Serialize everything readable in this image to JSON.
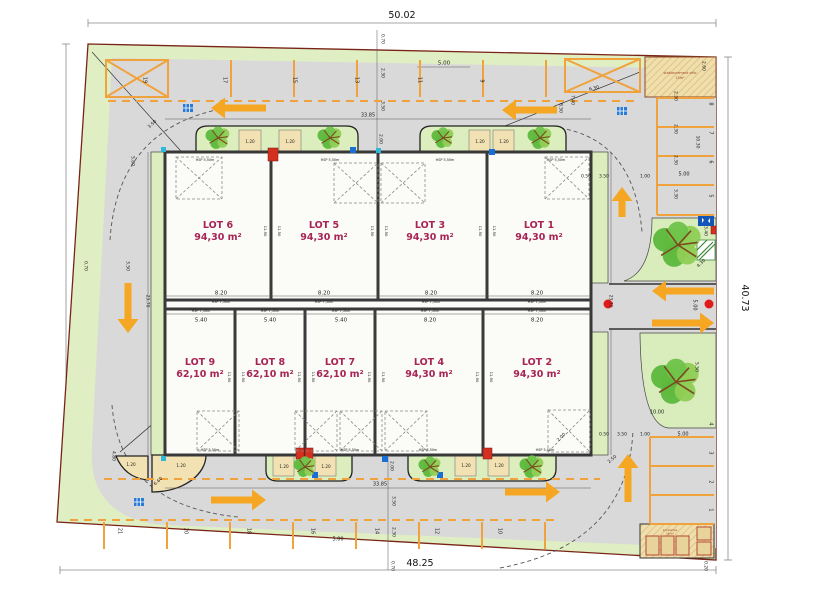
{
  "plan": {
    "outer": {
      "top": "50.02",
      "bottom": "48.25",
      "left": "40.77",
      "right": "40.73"
    },
    "colors": {
      "site_green": "#DFEFC3",
      "verge_green": "#DCEEBD",
      "asphalt": "#D9D9D9",
      "marking_orange": "#F0A23C",
      "arrow_orange": "#F5A623",
      "wall_dark": "#3A3A3A",
      "boundary_red": "#7A2417",
      "lot_label": "#A62456",
      "planter_tan": "#F2E2B3",
      "hatch_tan": "#F0DFAC",
      "red_dot": "#E01B1B",
      "utility_blue": "#1A6FD4",
      "utility_cyan": "#2FB8D8",
      "sign_blue": "#1456B8"
    },
    "lots": [
      {
        "name": "LOT 6",
        "area": "94,30 m²",
        "x": 218,
        "y": 228
      },
      {
        "name": "LOT 5",
        "area": "94,30 m²",
        "x": 324,
        "y": 228
      },
      {
        "name": "LOT 3",
        "area": "94,30 m²",
        "x": 430,
        "y": 228
      },
      {
        "name": "LOT 1",
        "area": "94,30 m²",
        "x": 539,
        "y": 228
      },
      {
        "name": "LOT 9",
        "area": "62,10 m²",
        "x": 200,
        "y": 365
      },
      {
        "name": "LOT 8",
        "area": "62,10 m²",
        "x": 270,
        "y": 365
      },
      {
        "name": "LOT 7",
        "area": "62,10 m²",
        "x": 340,
        "y": 365
      },
      {
        "name": "LOT 4",
        "area": "94,30 m²",
        "x": 429,
        "y": 365
      },
      {
        "name": "LOT 2",
        "area": "94,30 m²",
        "x": 537,
        "y": 365
      }
    ],
    "stalls": [
      {
        "n": "19",
        "x": 145,
        "y": 80
      },
      {
        "n": "17",
        "x": 225,
        "y": 80
      },
      {
        "n": "15",
        "x": 295,
        "y": 80
      },
      {
        "n": "13",
        "x": 357,
        "y": 80
      },
      {
        "n": "11",
        "x": 420,
        "y": 80
      },
      {
        "n": "9",
        "x": 482,
        "y": 81
      },
      {
        "n": "21",
        "x": 120,
        "y": 531
      },
      {
        "n": "20",
        "x": 186,
        "y": 531
      },
      {
        "n": "18",
        "x": 249,
        "y": 531
      },
      {
        "n": "16",
        "x": 313,
        "y": 531
      },
      {
        "n": "14",
        "x": 377,
        "y": 531
      },
      {
        "n": "12",
        "x": 437,
        "y": 531
      },
      {
        "n": "10",
        "x": 500,
        "y": 531
      },
      {
        "n": "8",
        "x": 711,
        "y": 104
      },
      {
        "n": "7",
        "x": 711,
        "y": 133
      },
      {
        "n": "6",
        "x": 711,
        "y": 162
      },
      {
        "n": "5",
        "x": 711,
        "y": 196
      },
      {
        "n": "4",
        "x": 711,
        "y": 424
      },
      {
        "n": "3",
        "x": 711,
        "y": 453
      },
      {
        "n": "2",
        "x": 711,
        "y": 482
      },
      {
        "n": "1",
        "x": 711,
        "y": 510
      }
    ],
    "dim_labels": [
      {
        "t": "0.70",
        "x": 383,
        "y": 39,
        "r": 90,
        "s": 4.5
      },
      {
        "t": "2.30",
        "x": 383,
        "y": 73,
        "r": 90,
        "s": 4.5
      },
      {
        "t": "3.50",
        "x": 383,
        "y": 106,
        "r": 90,
        "s": 4.5
      },
      {
        "t": "2.00",
        "x": 381,
        "y": 139,
        "r": 90,
        "s": 4.5
      },
      {
        "t": "5.00",
        "x": 444,
        "y": 63,
        "s": 5.5
      },
      {
        "t": "33.85",
        "x": 368,
        "y": 115,
        "s": 5
      },
      {
        "t": "3.50",
        "x": 152,
        "y": 124,
        "r": -42,
        "s": 4.5
      },
      {
        "t": "5.80",
        "x": 133,
        "y": 161,
        "r": 90,
        "s": 4.5
      },
      {
        "t": "8.50",
        "x": 561,
        "y": 108,
        "r": 90,
        "s": 4.5
      },
      {
        "t": "7.40",
        "x": 573,
        "y": 100,
        "r": 90,
        "s": 4.5
      },
      {
        "t": "6.30",
        "x": 594,
        "y": 88,
        "r": -14,
        "s": 4.5
      },
      {
        "t": "2.60",
        "x": 704,
        "y": 66,
        "r": 90,
        "s": 4.5
      },
      {
        "t": "10.30",
        "x": 698,
        "y": 142,
        "r": 90,
        "s": 4.5
      },
      {
        "t": "2.30",
        "x": 676,
        "y": 96,
        "r": 90,
        "s": 4.5
      },
      {
        "t": "2.30",
        "x": 676,
        "y": 129,
        "r": 90,
        "s": 4.5
      },
      {
        "t": "2.30",
        "x": 676,
        "y": 160,
        "r": 90,
        "s": 4.5
      },
      {
        "t": "3.30",
        "x": 676,
        "y": 194,
        "r": 90,
        "s": 4.5
      },
      {
        "t": "5.00",
        "x": 684,
        "y": 174,
        "s": 5
      },
      {
        "t": "0.50",
        "x": 586,
        "y": 176,
        "s": 4.5
      },
      {
        "t": "3.50",
        "x": 604,
        "y": 176,
        "s": 4.5
      },
      {
        "t": "1.00",
        "x": 645,
        "y": 176,
        "s": 4.5
      },
      {
        "t": "3.40",
        "x": 706,
        "y": 231,
        "r": 90,
        "s": 4.5
      },
      {
        "t": "4.30",
        "x": 701,
        "y": 263,
        "r": -45,
        "s": 4.5
      },
      {
        "t": "5.00",
        "x": 695,
        "y": 305,
        "r": 90,
        "s": 5
      },
      {
        "t": "23.70",
        "x": 611,
        "y": 301,
        "r": 90,
        "s": 4.5
      },
      {
        "t": "23.70",
        "x": 148,
        "y": 301,
        "r": 90,
        "s": 4.5
      },
      {
        "t": "0.70",
        "x": 86,
        "y": 266,
        "r": 90,
        "s": 4.5
      },
      {
        "t": "3.50",
        "x": 128,
        "y": 266,
        "r": 90,
        "s": 4.5
      },
      {
        "t": "5.50",
        "x": 697,
        "y": 367,
        "r": 90,
        "s": 4.5
      },
      {
        "t": "0.50",
        "x": 604,
        "y": 434,
        "s": 4.5
      },
      {
        "t": "3.50",
        "x": 622,
        "y": 434,
        "s": 4.5
      },
      {
        "t": "1.00",
        "x": 645,
        "y": 434,
        "s": 4.5
      },
      {
        "t": "5.00",
        "x": 683,
        "y": 434,
        "s": 5
      },
      {
        "t": "10.00",
        "x": 657,
        "y": 412,
        "s": 5
      },
      {
        "t": "2.50",
        "x": 612,
        "y": 459,
        "r": -40,
        "s": 4.5
      },
      {
        "t": "2.00",
        "x": 561,
        "y": 437,
        "r": -45,
        "s": 4.5
      },
      {
        "t": "4.80",
        "x": 114,
        "y": 456,
        "r": 90,
        "s": 4.5
      },
      {
        "t": "6.60",
        "x": 158,
        "y": 481,
        "r": -42,
        "s": 4.5
      },
      {
        "t": "33.85",
        "x": 380,
        "y": 484,
        "s": 5
      },
      {
        "t": "2.00",
        "x": 392,
        "y": 466,
        "r": 90,
        "s": 4.5
      },
      {
        "t": "3.50",
        "x": 394,
        "y": 501,
        "r": 90,
        "s": 4.5
      },
      {
        "t": "2.30",
        "x": 394,
        "y": 532,
        "r": 90,
        "s": 4.5
      },
      {
        "t": "0.70",
        "x": 393,
        "y": 566,
        "r": 90,
        "s": 4.5
      },
      {
        "t": "5.00",
        "x": 338,
        "y": 539,
        "s": 5
      },
      {
        "t": "0.20",
        "x": 706,
        "y": 566,
        "r": 90,
        "s": 4.5
      },
      {
        "t": "8.20",
        "x": 221,
        "y": 293,
        "s": 5.5
      },
      {
        "t": "8.20",
        "x": 324,
        "y": 293,
        "s": 5.5
      },
      {
        "t": "8.20",
        "x": 431,
        "y": 293,
        "s": 5.5
      },
      {
        "t": "8.20",
        "x": 537,
        "y": 293,
        "s": 5.5
      },
      {
        "t": "5.40",
        "x": 201,
        "y": 320,
        "s": 5.5
      },
      {
        "t": "5.40",
        "x": 270,
        "y": 320,
        "s": 5.5
      },
      {
        "t": "5.40",
        "x": 341,
        "y": 320,
        "s": 5.5
      },
      {
        "t": "8.20",
        "x": 430,
        "y": 320,
        "s": 5.5
      },
      {
        "t": "8.20",
        "x": 537,
        "y": 320,
        "s": 5.5
      },
      {
        "t": "1.20",
        "x": 250,
        "y": 142,
        "s": 4.2
      },
      {
        "t": "1.20",
        "x": 290,
        "y": 142,
        "s": 4.2
      },
      {
        "t": "1.20",
        "x": 480,
        "y": 142,
        "s": 4.2
      },
      {
        "t": "1.20",
        "x": 504,
        "y": 142,
        "s": 4.2
      },
      {
        "t": "1.20",
        "x": 284,
        "y": 467,
        "s": 4.2
      },
      {
        "t": "1.20",
        "x": 326,
        "y": 467,
        "s": 4.2
      },
      {
        "t": "1.20",
        "x": 466,
        "y": 466,
        "s": 4.2
      },
      {
        "t": "1.20",
        "x": 499,
        "y": 466,
        "s": 4.2
      },
      {
        "t": "1.20",
        "x": 181,
        "y": 466,
        "s": 4.2
      },
      {
        "t": "1.20",
        "x": 131,
        "y": 465,
        "s": 4.2
      },
      {
        "t": "11.50",
        "x": 265,
        "y": 231,
        "r": 90,
        "s": 3.8
      },
      {
        "t": "11.50",
        "x": 279,
        "y": 231,
        "r": 90,
        "s": 3.8
      },
      {
        "t": "11.50",
        "x": 372,
        "y": 231,
        "r": 90,
        "s": 3.8
      },
      {
        "t": "11.50",
        "x": 386,
        "y": 231,
        "r": 90,
        "s": 3.8
      },
      {
        "t": "11.50",
        "x": 480,
        "y": 231,
        "r": 90,
        "s": 3.8
      },
      {
        "t": "11.50",
        "x": 494,
        "y": 231,
        "r": 90,
        "s": 3.8
      },
      {
        "t": "11.50",
        "x": 229,
        "y": 377,
        "r": 90,
        "s": 3.8
      },
      {
        "t": "11.50",
        "x": 243,
        "y": 377,
        "r": 90,
        "s": 3.8
      },
      {
        "t": "11.50",
        "x": 299,
        "y": 377,
        "r": 90,
        "s": 3.8
      },
      {
        "t": "11.50",
        "x": 313,
        "y": 377,
        "r": 90,
        "s": 3.8
      },
      {
        "t": "11.50",
        "x": 369,
        "y": 377,
        "r": 90,
        "s": 3.8
      },
      {
        "t": "11.50",
        "x": 383,
        "y": 377,
        "r": 90,
        "s": 3.8
      },
      {
        "t": "11.50",
        "x": 477,
        "y": 377,
        "r": 90,
        "s": 3.8
      },
      {
        "t": "11.50",
        "x": 491,
        "y": 377,
        "r": 90,
        "s": 3.8
      },
      {
        "t": "HSP 7,50m",
        "x": 221,
        "y": 302,
        "s": 3.4
      },
      {
        "t": "HSP 7,50m",
        "x": 324,
        "y": 302,
        "s": 3.4
      },
      {
        "t": "HSP 7,50m",
        "x": 431,
        "y": 302,
        "s": 3.4
      },
      {
        "t": "HSP 7,50m",
        "x": 537,
        "y": 302,
        "s": 3.4
      },
      {
        "t": "HSP 7,50m",
        "x": 201,
        "y": 311,
        "s": 3.4
      },
      {
        "t": "HSP 7,50m",
        "x": 270,
        "y": 311,
        "s": 3.4
      },
      {
        "t": "HSP 7,50m",
        "x": 341,
        "y": 311,
        "s": 3.4
      },
      {
        "t": "HSP 7,50m",
        "x": 430,
        "y": 311,
        "s": 3.4
      },
      {
        "t": "HSP 7,50m",
        "x": 537,
        "y": 311,
        "s": 3.4
      },
      {
        "t": "HSP 5,50m",
        "x": 205,
        "y": 160,
        "s": 3.4
      },
      {
        "t": "HSP 5,50m",
        "x": 330,
        "y": 160,
        "s": 3.4
      },
      {
        "t": "HSP 5,50m",
        "x": 445,
        "y": 160,
        "s": 3.4
      },
      {
        "t": "HSP 5,50m",
        "x": 556,
        "y": 160,
        "s": 3.4
      },
      {
        "t": "HSP 5,50m",
        "x": 210,
        "y": 450,
        "s": 3.4
      },
      {
        "t": "HSP 5,50m",
        "x": 350,
        "y": 450,
        "s": 3.4
      },
      {
        "t": "HSP 5,50m",
        "x": 428,
        "y": 450,
        "s": 3.4
      },
      {
        "t": "HSP 5,50m",
        "x": 545,
        "y": 450,
        "s": 3.4
      }
    ],
    "bike_shelter": {
      "line1": "stationnement vélo",
      "line2": "15m²"
    },
    "waste_area": {
      "line1": "poubelles",
      "line2": "16m²"
    }
  }
}
